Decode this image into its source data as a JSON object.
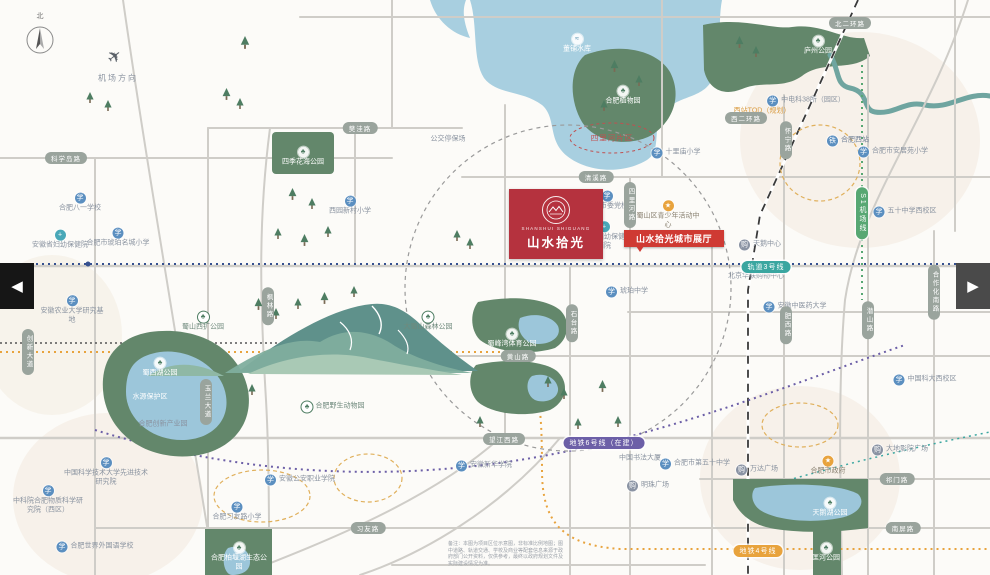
{
  "map": {
    "compass_label": "北",
    "airport_label": "机场方向",
    "nav_prev": "◀",
    "nav_next": "▶"
  },
  "project": {
    "latin": "SHANSHUI SHIGUANG",
    "name": "山水拾光",
    "callout": "山水拾光城市展厅",
    "area_badge": "四里河片区"
  },
  "colors": {
    "project_red": "#b5323e",
    "callout_red": "#cf3a33",
    "park_green": "#63876b",
    "water_blue": "#a8cfe0",
    "metro_line3": "#3aa6a0",
    "metro_line6": "#6c5fa7",
    "metro_line4": "#e8a33d",
    "metro_s1": "#57a773"
  },
  "roads": [
    {
      "label": "科学岛路",
      "x": 66,
      "y": 158
    },
    {
      "label": "樊洼路",
      "x": 360,
      "y": 128
    },
    {
      "label": "清溪路",
      "x": 596,
      "y": 177
    },
    {
      "label": "北二环路",
      "x": 850,
      "y": 23
    },
    {
      "label": "西二环路",
      "x": 746,
      "y": 118
    },
    {
      "label": "黄山路",
      "x": 518,
      "y": 356
    },
    {
      "label": "望江西路",
      "x": 504,
      "y": 439
    },
    {
      "label": "习友路",
      "x": 368,
      "y": 528
    },
    {
      "label": "祁门路",
      "x": 897,
      "y": 479
    },
    {
      "label": "南屏路",
      "x": 903,
      "y": 528
    },
    {
      "label": "四里河路",
      "x": 630,
      "y": 205,
      "vert": true
    },
    {
      "label": "怀宁路",
      "x": 786,
      "y": 140,
      "vert": true
    },
    {
      "label": "枫林路",
      "x": 268,
      "y": 306,
      "vert": true
    },
    {
      "label": "玉兰大道",
      "x": 206,
      "y": 402,
      "vert": true
    },
    {
      "label": "创新大道",
      "x": 28,
      "y": 352,
      "vert": true
    },
    {
      "label": "石台路",
      "x": 572,
      "y": 323,
      "vert": true
    },
    {
      "label": "肥西路",
      "x": 786,
      "y": 325,
      "vert": true
    },
    {
      "label": "潜山路",
      "x": 868,
      "y": 320,
      "vert": true
    },
    {
      "label": "合作化南路",
      "x": 934,
      "y": 292,
      "vert": true
    }
  ],
  "metro": [
    {
      "label": "轨道3号线",
      "x": 766,
      "y": 267,
      "color": "#3aa6a0"
    },
    {
      "label": "地铁6号线（在建）",
      "x": 604,
      "y": 443,
      "color": "#6c5fa7"
    },
    {
      "label": "地铁4号线",
      "x": 758,
      "y": 551,
      "color": "#e8a33d"
    },
    {
      "label": "S1机场线",
      "x": 862,
      "y": 213,
      "color": "#57a773",
      "vert": true
    }
  ],
  "pois": [
    {
      "label": "董铺水库",
      "x": 577,
      "y": 44,
      "type": "water",
      "stack": true
    },
    {
      "label": "合肥植物园",
      "x": 623,
      "y": 96,
      "type": "parkwhite",
      "stack": true
    },
    {
      "label": "庐州公园",
      "x": 818,
      "y": 46,
      "type": "parkwhite",
      "stack": true
    },
    {
      "label": "四季花海公园",
      "x": 303,
      "y": 157,
      "type": "parkwhite",
      "stack": true
    },
    {
      "label": "合肥西站",
      "x": 848,
      "y": 141,
      "type": "train"
    },
    {
      "label": "中电科38所（园区）",
      "x": 806,
      "y": 101,
      "type": "school"
    },
    {
      "label": "西站TOD（规划）",
      "x": 762,
      "y": 112,
      "type": "orange"
    },
    {
      "label": "合肥八一学校",
      "x": 80,
      "y": 203,
      "type": "school",
      "stack": true
    },
    {
      "label": "安徽省妇幼保健院",
      "x": 60,
      "y": 240,
      "type": "hospital",
      "stack": true
    },
    {
      "label": "合肥市琥珀名城小学",
      "x": 118,
      "y": 238,
      "type": "school",
      "stack": true
    },
    {
      "label": "西园新村小学",
      "x": 350,
      "y": 206,
      "type": "school",
      "stack": true
    },
    {
      "label": "公交停保场",
      "x": 448,
      "y": 140,
      "type": "plain"
    },
    {
      "label": "合肥市委党校",
      "x": 607,
      "y": 201,
      "type": "school",
      "stack": true
    },
    {
      "label": "十里庙小学",
      "x": 676,
      "y": 153,
      "type": "school"
    },
    {
      "label": "蜀山区青少年活动中心",
      "x": 668,
      "y": 215,
      "type": "gov",
      "stack": true,
      "w": 64
    },
    {
      "label": "安徽省妇幼保健院西院",
      "x": 604,
      "y": 236,
      "type": "hospital",
      "stack": true,
      "w": 58
    },
    {
      "label": "琥珀中学",
      "x": 627,
      "y": 292,
      "type": "school"
    },
    {
      "label": "蜀山西扩公园",
      "x": 203,
      "y": 322,
      "type": "park",
      "stack": true
    },
    {
      "label": "大蜀山森林公园",
      "x": 428,
      "y": 322,
      "type": "park",
      "stack": true
    },
    {
      "label": "蜀峰湾体育公园",
      "x": 512,
      "y": 339,
      "type": "parkwhite",
      "stack": true
    },
    {
      "label": "合肥野生动物园",
      "x": 333,
      "y": 407,
      "type": "park"
    },
    {
      "label": "蜀西湖公园",
      "x": 160,
      "y": 368,
      "type": "parkwhite",
      "stack": true
    },
    {
      "label": "水源保护区",
      "x": 150,
      "y": 398,
      "type": "whiteplain"
    },
    {
      "label": "安徽农业大学研究基地",
      "x": 72,
      "y": 310,
      "type": "school",
      "stack": true,
      "w": 66
    },
    {
      "label": "合肥创新产业园",
      "x": 163,
      "y": 425,
      "type": "plain"
    },
    {
      "label": "中国科学技术大学先进技术研究院",
      "x": 106,
      "y": 472,
      "type": "school",
      "stack": true,
      "w": 84
    },
    {
      "label": "中科院合肥物质科学研究院（西区）",
      "x": 48,
      "y": 500,
      "type": "school",
      "stack": true,
      "w": 74
    },
    {
      "label": "合肥世界外国语学校",
      "x": 95,
      "y": 547,
      "type": "school"
    },
    {
      "label": "合肥习友路小学",
      "x": 237,
      "y": 512,
      "type": "school",
      "stack": true
    },
    {
      "label": "合肥柏堰湖生态公园",
      "x": 239,
      "y": 557,
      "type": "parkwhite",
      "stack": true,
      "w": 56
    },
    {
      "label": "安徽公安职业学院",
      "x": 300,
      "y": 480,
      "type": "school"
    },
    {
      "label": "安徽新华学院",
      "x": 484,
      "y": 466,
      "type": "school"
    },
    {
      "label": "中国书法大厦",
      "x": 640,
      "y": 459,
      "type": "plain"
    },
    {
      "label": "明珠广场",
      "x": 648,
      "y": 486,
      "type": "mall"
    },
    {
      "label": "合肥市第五十中学",
      "x": 695,
      "y": 464,
      "type": "school"
    },
    {
      "label": "万达广场",
      "x": 757,
      "y": 470,
      "type": "mall"
    },
    {
      "label": "合肥市政府",
      "x": 828,
      "y": 466,
      "type": "gov",
      "stack": true
    },
    {
      "label": "大地影院广场",
      "x": 900,
      "y": 450,
      "type": "mall"
    },
    {
      "label": "天鹅湖公园",
      "x": 830,
      "y": 508,
      "type": "parkwhite",
      "stack": true
    },
    {
      "label": "匡河公园",
      "x": 826,
      "y": 553,
      "type": "parkwhite",
      "stack": true,
      "w": 30
    },
    {
      "label": "天鹅中心",
      "x": 760,
      "y": 245,
      "type": "mall"
    },
    {
      "label": "北京华联购物中心",
      "x": 756,
      "y": 277,
      "type": "plain"
    },
    {
      "label": "合肥市安居苑小学",
      "x": 893,
      "y": 152,
      "type": "school"
    },
    {
      "label": "五十中学西校区",
      "x": 905,
      "y": 212,
      "type": "school"
    },
    {
      "label": "安徽中医药大学",
      "x": 795,
      "y": 307,
      "type": "school"
    },
    {
      "label": "中国科大西校区",
      "x": 925,
      "y": 380,
      "type": "school"
    }
  ],
  "disclaimer": "备注：本图为项目区位示意图，非标准比例地图；图中道路、轨道交通、学校及商业等配套信息来源于政府部门公开资料，仅供参考，最终以政府规划文件及实际建设情况为准。"
}
